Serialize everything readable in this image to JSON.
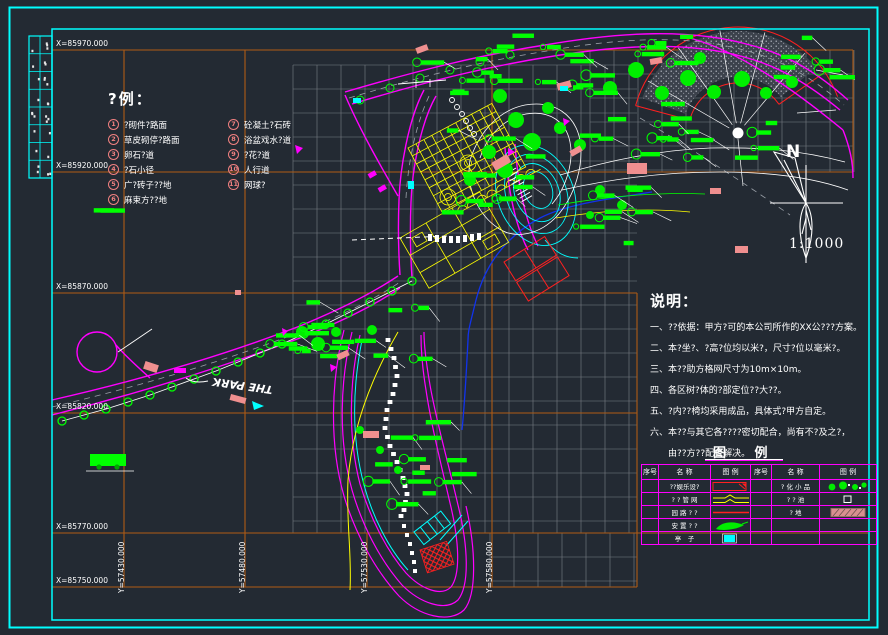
{
  "colors": {
    "background": "#232a33",
    "frame": "#00ffff",
    "grid_major": "#b05c14",
    "grid_minor": "#7a8086",
    "road": "#ff00ff",
    "vegetation": "#00ff00",
    "structure": "#ffff00",
    "water": "#00ffff",
    "annotation": "#ffffff",
    "key_number": "#f08080",
    "building": "#ef8f8f",
    "court": "#ff0000"
  },
  "coordinates": {
    "x_labels": [
      "X=85970.000",
      "X=85920.000",
      "X=85870.000",
      "X=85820.000",
      "X=85770.000",
      "X=85750.000"
    ],
    "y_labels": [
      "Y=57430.000",
      "Y=57480.000",
      "Y=57530.000",
      "Y=57580.000"
    ]
  },
  "legend": {
    "title": "?例：",
    "items": [
      {
        "num": "1",
        "label": "?砌件?路面"
      },
      {
        "num": "2",
        "label": "草皮砌停?路面"
      },
      {
        "num": "3",
        "label": "卵石?道"
      },
      {
        "num": "4",
        "label": "?石小径"
      },
      {
        "num": "5",
        "label": "广?砖子??地"
      },
      {
        "num": "6",
        "label": "麻束方??地"
      },
      {
        "num": "7",
        "label": "砼凝土?石砖"
      },
      {
        "num": "8",
        "label": "浴盆戏水?道"
      },
      {
        "num": "9",
        "label": "?花?道"
      },
      {
        "num": "10",
        "label": "人行道"
      },
      {
        "num": "11",
        "label": "网球?"
      }
    ]
  },
  "notes": {
    "title": "说明：",
    "lines": [
      "一、??依据：甲方?可的本公司所作的XX公???方案。",
      "二、本?坐?、?高?位均以米?，尺寸?位以毫米?。",
      "三、本??助方格网尺寸为10m×10m。",
      "四、各区树?体的?部定位??大??。",
      "五、?内??椅均采用成品，具体式?甲方自定。",
      "六、本??与其它各????密切配合，尚有不?及之?，",
      "由??方??配合解决。"
    ]
  },
  "legend_table": {
    "title": "图  例",
    "headers": [
      "序号",
      "名 称",
      "图 例",
      "序号",
      "名 称",
      "图 例"
    ],
    "left_rows": [
      {
        "name": "??娱乐设?"
      },
      {
        "name": "? ? 管 网"
      },
      {
        "name": "园 路 ? ?"
      },
      {
        "name": "安 置 ? ?"
      },
      {
        "name": "亭　子"
      }
    ],
    "right_rows": [
      {
        "name": "? 化 小 品"
      },
      {
        "name": "? ? 池"
      },
      {
        "name": "? 地"
      }
    ]
  },
  "compass": {
    "label": "N",
    "scale": "1:1000"
  },
  "map": {
    "park_label": "THE PARK"
  }
}
